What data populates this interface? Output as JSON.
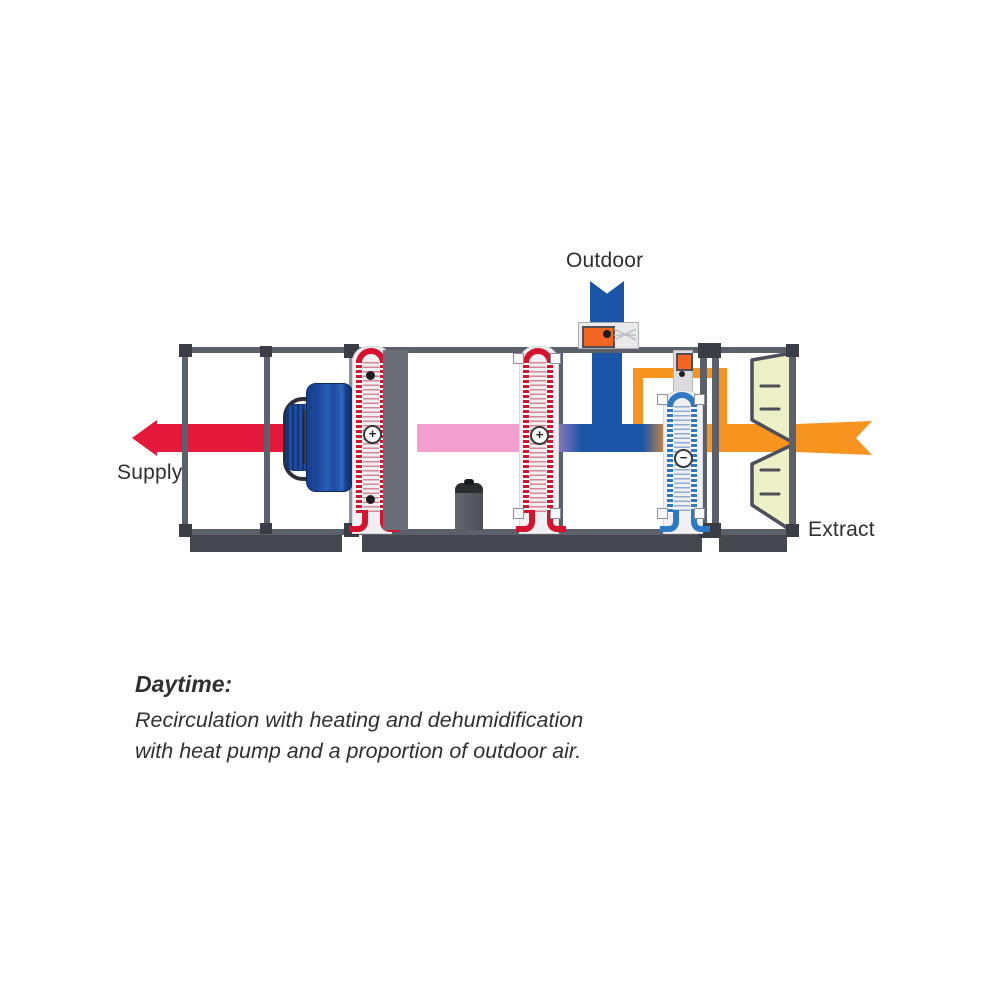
{
  "diagram": {
    "labels": {
      "outdoor": "Outdoor",
      "supply": "Supply",
      "extract": "Extract"
    },
    "caption": {
      "title": "Daytime:",
      "line1": "Recirculation with heating and dehumidification",
      "line2": "with heat pump and a proportion of outdoor air."
    },
    "symbols": {
      "heating_coil_1": "+",
      "condenser_coil": "+",
      "evaporator_coil": "−"
    },
    "colors": {
      "supply_air_red": "#e5173a",
      "recirculation_pink": "#f29fd0",
      "outdoor_air_blue": "#1b55a8",
      "extract_air_orange": "#f79420",
      "refrigerant_pipe_orange": "#f79420",
      "heating_coil_red": "#d5132e",
      "cooling_coil_blue": "#2e79c3",
      "casing_frame": "#5c606b",
      "casing_base": "#44474d",
      "filter_cream": "#edefc6",
      "damper_orange": "#f26522"
    }
  }
}
